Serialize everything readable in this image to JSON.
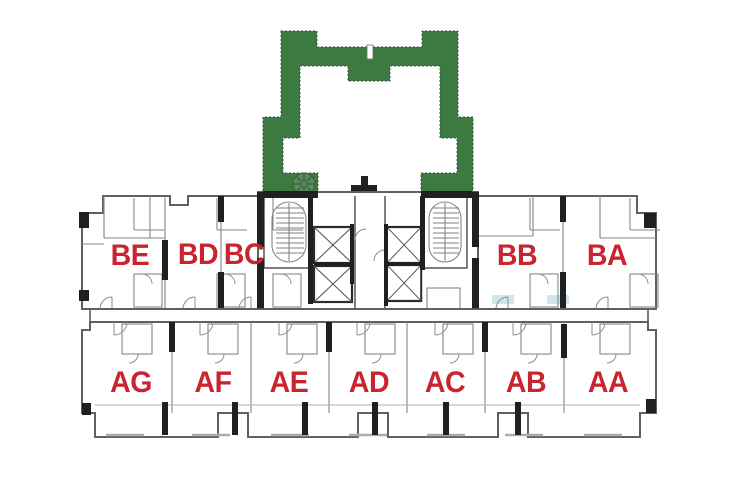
{
  "figure_type": "residential-tower-floor-plan",
  "units": {
    "upper": [
      {
        "label": "BE"
      },
      {
        "label": "BD"
      },
      {
        "label": "BC"
      },
      {
        "label": "BB"
      },
      {
        "label": "BA"
      }
    ],
    "lower": [
      {
        "label": "AG"
      },
      {
        "label": "AF"
      },
      {
        "label": "AE"
      },
      {
        "label": "AD"
      },
      {
        "label": "AC"
      },
      {
        "label": "AB"
      },
      {
        "label": "AA"
      }
    ]
  },
  "features": {
    "courtyard": "green landscaped sky-terrace outline at top center",
    "cores": [
      "left stairwell",
      "right stairwell",
      "four elevator shafts",
      "central lobby"
    ],
    "icons": [
      "tree-icon",
      "benchmark-cross-icon",
      "stair-oval",
      "elevator-x"
    ]
  },
  "colors": {
    "background": "#ffffff",
    "courtyard_green": "#3d7a41",
    "unit_label_red": "#c9242f",
    "wall_dark": "#1f2022",
    "wall_gray": "#5c6165",
    "bath_blue": "#cfe6ee"
  }
}
